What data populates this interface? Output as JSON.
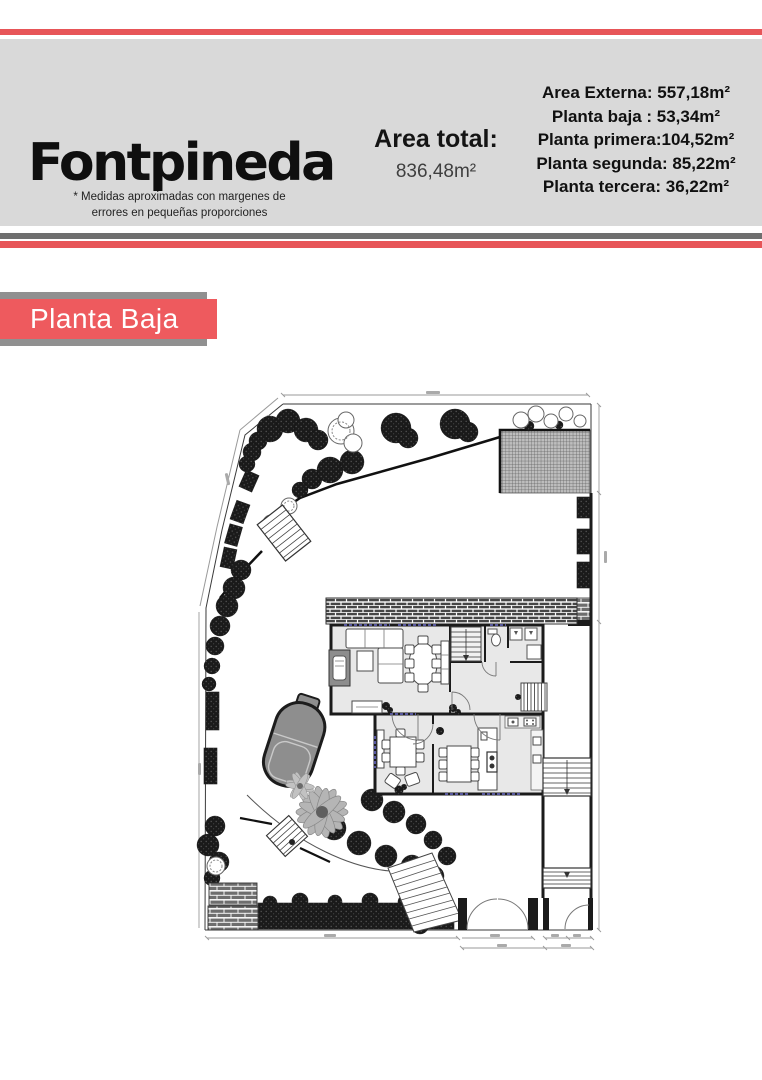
{
  "header": {
    "title": "Fontpineda",
    "area_total_label": "Area total:",
    "area_total_value": "836,48m²",
    "disclaimer_line1": "* Medidas aproximadas con margenes de",
    "disclaimer_line2": "errores en pequeñas proporciones",
    "areas": [
      "Area Externa: 557,18m²",
      "Planta baja : 53,34m²",
      "Planta primera:104,52m²",
      "Planta segunda: 85,22m²",
      "Planta tercera: 36,22m²"
    ]
  },
  "section": {
    "banner_label": "Planta Baja"
  },
  "colors": {
    "accent_red": "#e75558",
    "banner_red": "#ee5a5e",
    "banner_gray": "#909090",
    "header_gray": "#d9d9d9",
    "divider_gray": "#6f6f6f",
    "plan_ink": "#1c1c1c",
    "room_fill": "#e8e8e8",
    "pool_gray": "#8e8e8e"
  }
}
